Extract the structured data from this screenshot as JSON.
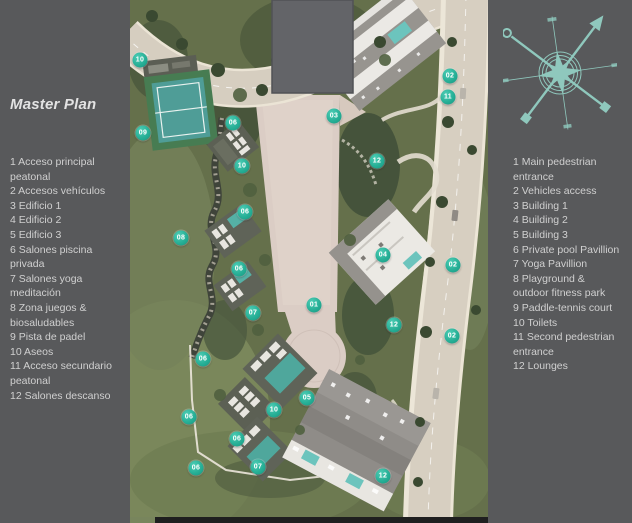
{
  "title": "Master Plan",
  "legend_es": {
    "items": [
      {
        "num": "1",
        "label": "Acceso principal peatonal"
      },
      {
        "num": "2",
        "label": "Accesos vehículos"
      },
      {
        "num": "3",
        "label": "Edificio 1"
      },
      {
        "num": "4",
        "label": "Edificio 2"
      },
      {
        "num": "5",
        "label": "Edificio 3"
      },
      {
        "num": "6",
        "label": "Salones piscina privada"
      },
      {
        "num": "7",
        "label": "Salones yoga meditación"
      },
      {
        "num": "8",
        "label": "Zona juegos & biosaludables"
      },
      {
        "num": "9",
        "label": "Pista de padel"
      },
      {
        "num": "10",
        "label": "Aseos"
      },
      {
        "num": "11",
        "label": "Acceso secundario peatonal"
      },
      {
        "num": "12",
        "label": "Salones descanso"
      }
    ]
  },
  "legend_en": {
    "items": [
      {
        "num": "1",
        "label": "Main pedestrian entrance"
      },
      {
        "num": "2",
        "label": "Vehicles access"
      },
      {
        "num": "3",
        "label": "Building 1"
      },
      {
        "num": "4",
        "label": "Building 2"
      },
      {
        "num": "5",
        "label": "Building 3"
      },
      {
        "num": "6",
        "label": "Private pool Pavillion"
      },
      {
        "num": "7",
        "label": "Yoga Pavillion"
      },
      {
        "num": "8",
        "label": "Playground & outdoor fitness park"
      },
      {
        "num": "9",
        "label": "Paddle-tennis court"
      },
      {
        "num": "10",
        "label": "Toilets"
      },
      {
        "num": "11",
        "label": "Second pedestrian entrance"
      },
      {
        "num": "12",
        "label": "Lounges"
      }
    ]
  },
  "map": {
    "markers": [
      {
        "label": "10",
        "x": 140,
        "y": 60
      },
      {
        "label": "09",
        "x": 143,
        "y": 133
      },
      {
        "label": "06",
        "x": 233,
        "y": 123
      },
      {
        "label": "10",
        "x": 242,
        "y": 166
      },
      {
        "label": "06",
        "x": 245,
        "y": 212
      },
      {
        "label": "08",
        "x": 181,
        "y": 238
      },
      {
        "label": "06",
        "x": 239,
        "y": 269
      },
      {
        "label": "07",
        "x": 253,
        "y": 313
      },
      {
        "label": "01",
        "x": 314,
        "y": 305
      },
      {
        "label": "03",
        "x": 334,
        "y": 116
      },
      {
        "label": "12",
        "x": 377,
        "y": 161
      },
      {
        "label": "02",
        "x": 450,
        "y": 76
      },
      {
        "label": "11",
        "x": 448,
        "y": 97
      },
      {
        "label": "04",
        "x": 383,
        "y": 255
      },
      {
        "label": "02",
        "x": 453,
        "y": 265
      },
      {
        "label": "12",
        "x": 394,
        "y": 325
      },
      {
        "label": "02",
        "x": 452,
        "y": 336
      },
      {
        "label": "06",
        "x": 203,
        "y": 359
      },
      {
        "label": "05",
        "x": 307,
        "y": 398
      },
      {
        "label": "10",
        "x": 274,
        "y": 410
      },
      {
        "label": "06",
        "x": 189,
        "y": 417
      },
      {
        "label": "06",
        "x": 237,
        "y": 439
      },
      {
        "label": "06",
        "x": 196,
        "y": 468
      },
      {
        "label": "07",
        "x": 258,
        "y": 467
      },
      {
        "label": "12",
        "x": 383,
        "y": 476
      }
    ]
  },
  "theme": {
    "background": "#58595b",
    "legend_text": "#d0d0d0",
    "marker_teal": "#27b097",
    "compass_teal": "#8fc8bd"
  }
}
